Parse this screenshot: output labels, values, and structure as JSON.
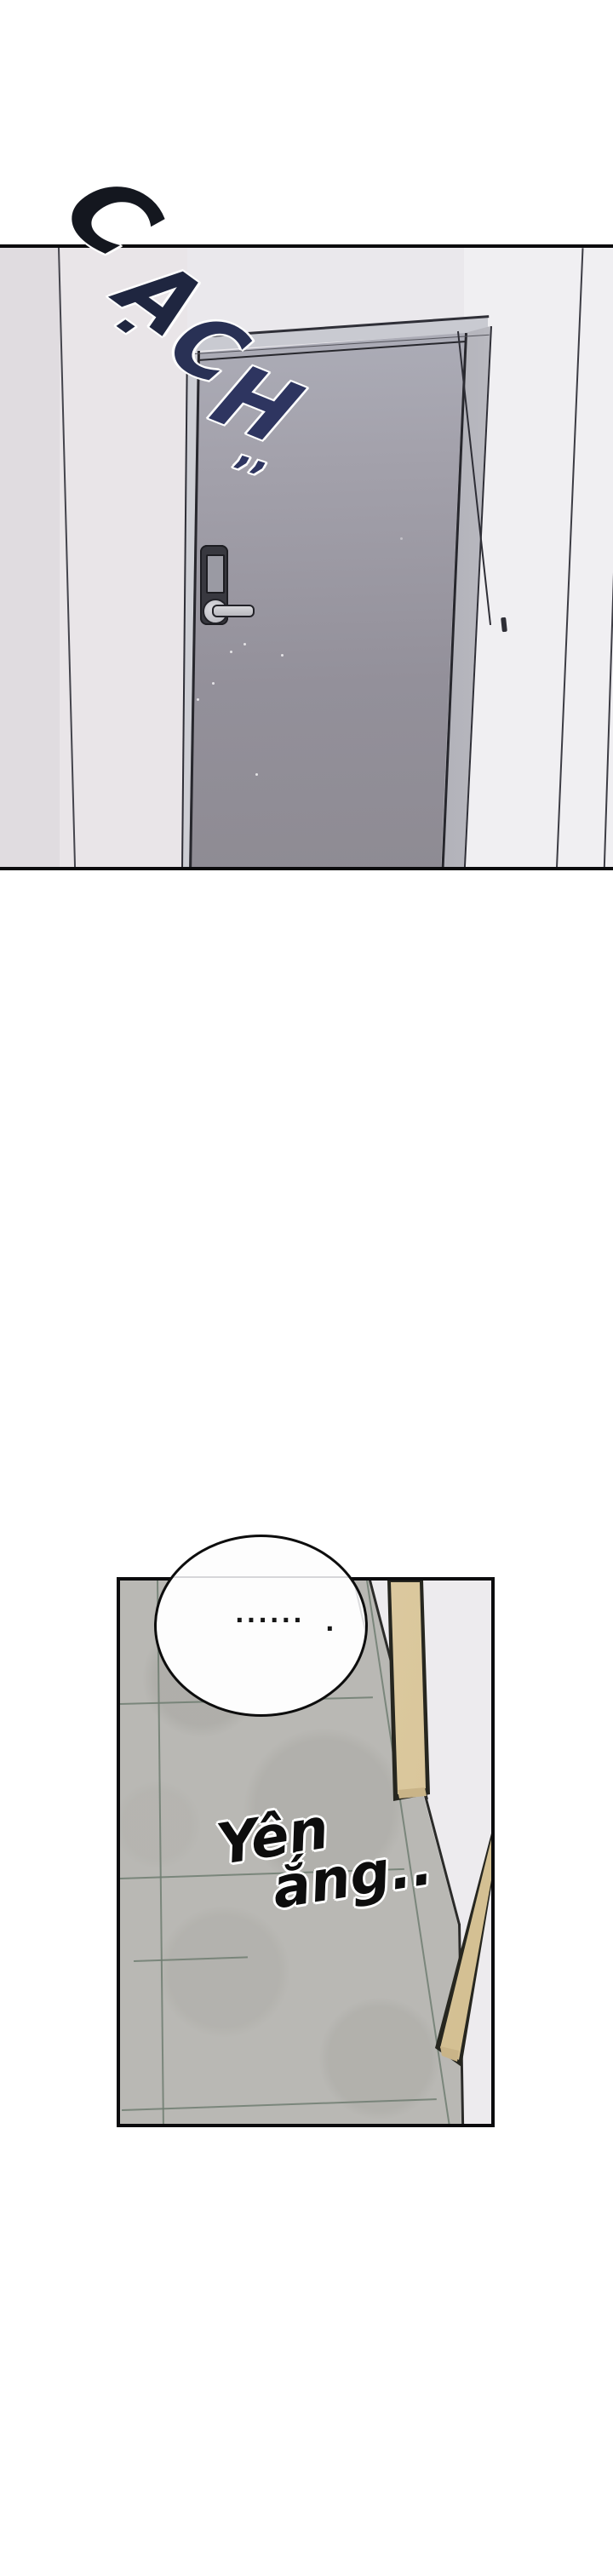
{
  "comic": {
    "panel1": {
      "sfx": {
        "word": "CẠCH",
        "letters": [
          "C",
          "Ạ",
          "C",
          "H"
        ],
        "marks": "’’"
      }
    },
    "panel2": {
      "bubble_dots": "......",
      "bubble_dot_tail": ".",
      "caption_line1": "Yên",
      "caption_line2": "ắng.."
    },
    "colors": {
      "sfx_navy": "#2e3560",
      "door_gray": "#9b99a3",
      "door_frame": "#cdced4",
      "lock_dark": "#38383f",
      "tile_gray": "#b9b8b4",
      "grout_green": "#6f7d71",
      "wood_tan": "#dcc9a0",
      "wall_white": "#edebee",
      "panel_border": "#0b0b0d"
    }
  }
}
